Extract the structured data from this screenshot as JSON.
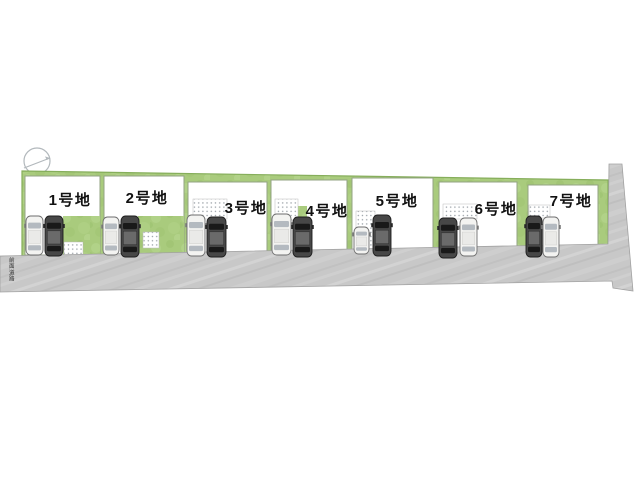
{
  "canvas": {
    "width": 640,
    "height": 480,
    "background": "#ffffff"
  },
  "compass": {
    "icon": "north-compass",
    "color": "#b2b8bc"
  },
  "road": {
    "label": "前面道路",
    "surface_color": "#c8c8c8",
    "edge_color": "#a2a2a2"
  },
  "field": {
    "color": "#a9cb7d",
    "edge_color": "#86ae5b"
  },
  "paving": {
    "dot_color": "#99a0a6",
    "base_color": "#ffffff"
  },
  "lots": [
    {
      "id": 1,
      "label": "1号地",
      "cars": [
        "white",
        "dark"
      ],
      "paved_area": "patio-bottom-right",
      "garden": "bottom-right"
    },
    {
      "id": 2,
      "label": "2号地",
      "cars": [
        "white",
        "dark"
      ],
      "paved_area": "patio-bottom-right",
      "garden": "bottom-right"
    },
    {
      "id": 3,
      "label": "3号地",
      "cars": [
        "white",
        "dark"
      ],
      "paved_area": "strip-top-left",
      "garden": null
    },
    {
      "id": 4,
      "label": "4号地",
      "cars": [
        "white",
        "dark"
      ],
      "paved_area": "strip-top-left",
      "garden": "small-patch"
    },
    {
      "id": 5,
      "label": "5号地",
      "cars": [
        "white-compact",
        "dark"
      ],
      "paved_area": "strip-left-vertical",
      "garden": null
    },
    {
      "id": 6,
      "label": "6号地",
      "cars": [
        "dark",
        "white"
      ],
      "paved_area": "strip-top",
      "garden": null
    },
    {
      "id": 7,
      "label": "7号地",
      "cars": [
        "dark",
        "white"
      ],
      "paved_area": "strip-top",
      "garden": null
    }
  ],
  "car_colors": {
    "white_body": "#f3f3f1",
    "dark_body": "#474747"
  }
}
